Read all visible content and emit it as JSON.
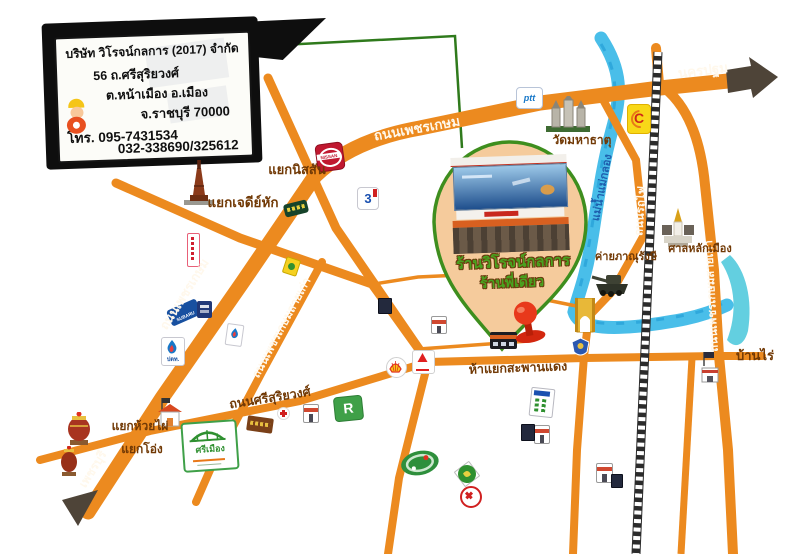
{
  "card": {
    "company": "บริษัท วิโรจน์กลการ (2017) จำกัด",
    "address1": "56 ถ.ศรีสุริยวงศ์",
    "address2": "ต.หน้าเมือง อ.เมือง",
    "address3": "จ.ราชบุรี 70000",
    "phone1": "โทร. 095-7431534",
    "phone2": "032-338690/325612"
  },
  "balloon": {
    "line1": "ร้านวิโรจน์กลการ",
    "line2": "ร้านพี่เดียว"
  },
  "roads": {
    "phetkasem_upper": "ถนนเพชรเกษม",
    "phetkasem_lower": "ถนนเพชรเกษม",
    "to_nakhon_pathom": "นครปฐม",
    "to_phetchaburi": "เพชรบุรี",
    "old_phetkasem_west": "ถนนเพชรเกษมสายเก่า",
    "old_phetkasem_east": "ถนนเพชรเกษมสายเก่า",
    "rotfai": "ถนนรถไฟ",
    "srisuriyawong": "ถนนศรีสุริยวงศ์"
  },
  "junctions": {
    "nissan": "แยกนิสสัน",
    "jedi_hak": "แยกเจดีย์หัก",
    "huai_phai": "แยกห้วยไผ่",
    "ong": "แยกโอ่ง",
    "saphan_daeng": "ห้าแยกสะพานแดง",
    "ban_rai": "บ้านไร่"
  },
  "places": {
    "wat_mahathat": "วัดมหาธาตุ",
    "city_pillar": "ศาลหลักเมือง",
    "army_camp": "ค่ายภาณุรังษี",
    "river": "แม่น้ำแม่กลอง"
  },
  "signs": {
    "nissan": "NISSAN",
    "ch3": "3",
    "subaru": "SUBARU",
    "ptt": "ปตท.",
    "ptt_en": "ptt",
    "c_mart": "C",
    "robinson": "R",
    "srimueang": "ศรีเมือง"
  },
  "colors": {
    "road": "#EC8A1F",
    "river": "#49BEE9",
    "balloon_border": "#3E8E1E",
    "balloon_fill": "#F5CB9C",
    "label_dark": "#713905",
    "label_light": "#FFF8EC",
    "river_label": "#1E5FAE"
  }
}
